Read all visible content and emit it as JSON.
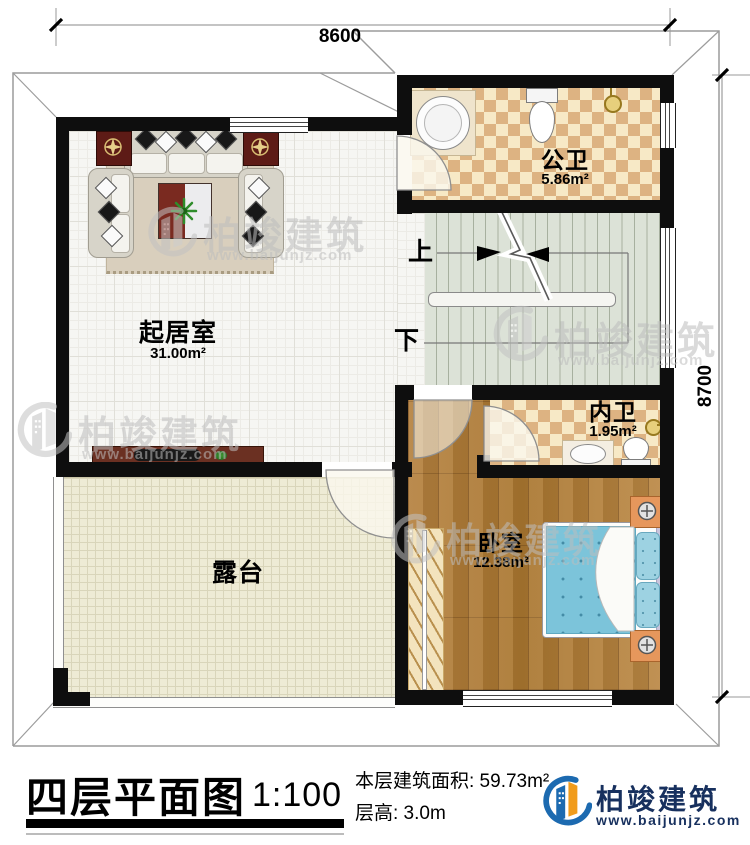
{
  "dims": {
    "width": "8600",
    "height": "8700"
  },
  "rooms": {
    "public_bath": {
      "name": "公卫",
      "area": "5.86m²"
    },
    "living": {
      "name": "起居室",
      "area": "31.00m²"
    },
    "ensuite_bath": {
      "name": "内卫",
      "area": "1.95m²"
    },
    "bedroom": {
      "name": "卧室",
      "area": "12.38m²"
    },
    "terrace": {
      "name": "露台"
    }
  },
  "stairs": {
    "up": "上",
    "down": "下"
  },
  "watermark": {
    "brand": "柏竣建筑",
    "url": "www.baijunjz.com"
  },
  "title_block": {
    "title": "四层平面图",
    "scale": "1:100",
    "floor_area": "本层建筑面积: 59.73m²",
    "floor_height": "层高: 3.0m",
    "brand": "柏竣建筑",
    "website": "www.baijunjz.com"
  },
  "colors": {
    "brand_blue": "#1c6ab0",
    "brand_orange": "#f19c1c",
    "wall": "#0e0e0e"
  }
}
